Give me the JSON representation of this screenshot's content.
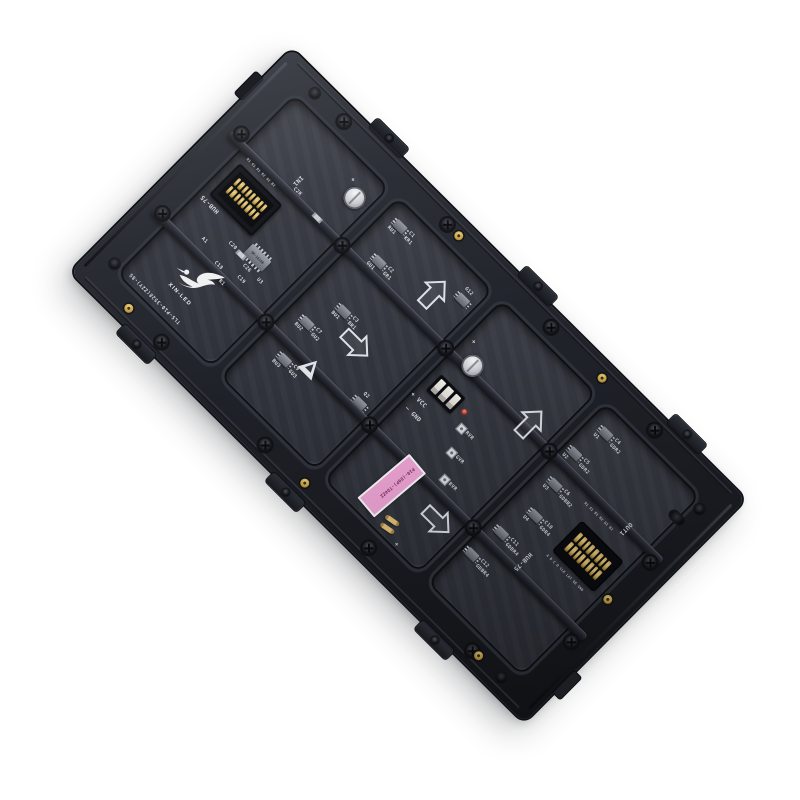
{
  "product": {
    "brand": "XIN-LED",
    "model_code": "TLS-P10-3528(ZZY)-8S",
    "tag_label": "P10-(89P)-TD4ZZ"
  },
  "colors": {
    "frame_plastic": "#23262e",
    "pcb": "#34373f",
    "silkscreen": "#d6d9de",
    "tag_pink": "#f0a6d6",
    "gold_insert": "#c8a244",
    "fuse_gold": "#d9b36a",
    "led_red": "#c5392e",
    "pin_gold": "#cba64e"
  },
  "input": {
    "port": "IN1",
    "bus": "HUB-75",
    "pins_top": "R1 G1 B1 R2 G2 B2"
  },
  "output": {
    "port": "OUT1",
    "bus": "HUB-75",
    "pins_top": "R1 G1 B1 R2 G2 B2",
    "pins_bottom": "A B C D CLK LAT OE GND"
  },
  "power": {
    "vcc": "VCC",
    "gnd": "GND",
    "plus": "+",
    "minus": "−"
  },
  "trimmers": {
    "r": "RVR",
    "g": "GVR",
    "b": "BVR"
  },
  "driver_ic": "SM-16188",
  "w1_parts": {
    "p1": "C2K",
    "p2": "C26",
    "p3": "U3",
    "p4": "C20",
    "p5": "C19",
    "p6": "C18",
    "p7": "R1",
    "p8": "A1"
  },
  "w2": {
    "groups": [
      {
        "ic": "RU1",
        "cap": "C1",
        "net": "KR1"
      },
      {
        "ic": "GU1",
        "cap": "C2",
        "net": "GR1"
      },
      {
        "ic": "BU1",
        "cap": "C3",
        "net": "BR1"
      },
      {
        "ic": "BU2",
        "cap": "C7",
        "net": "GU2"
      },
      {
        "ic": "BU3",
        "cap": "C9",
        "net": "GU3"
      }
    ],
    "extra1": "G12",
    "extra2": "Q2"
  },
  "w4": {
    "groups": [
      {
        "ic": "U1",
        "cap": "C4",
        "net": "GDR2"
      },
      {
        "ic": "U2",
        "cap": "C5",
        "net": "GDR2"
      },
      {
        "ic": "U3",
        "cap": "C6",
        "net": "GDBR2"
      },
      {
        "ic": "U4",
        "cap": "C10",
        "net": "GDR4"
      },
      {
        "ic": "",
        "cap": "C11",
        "net": "GDBR4"
      },
      {
        "ic": "",
        "cap": "C12",
        "net": "GDBR4"
      }
    ]
  }
}
